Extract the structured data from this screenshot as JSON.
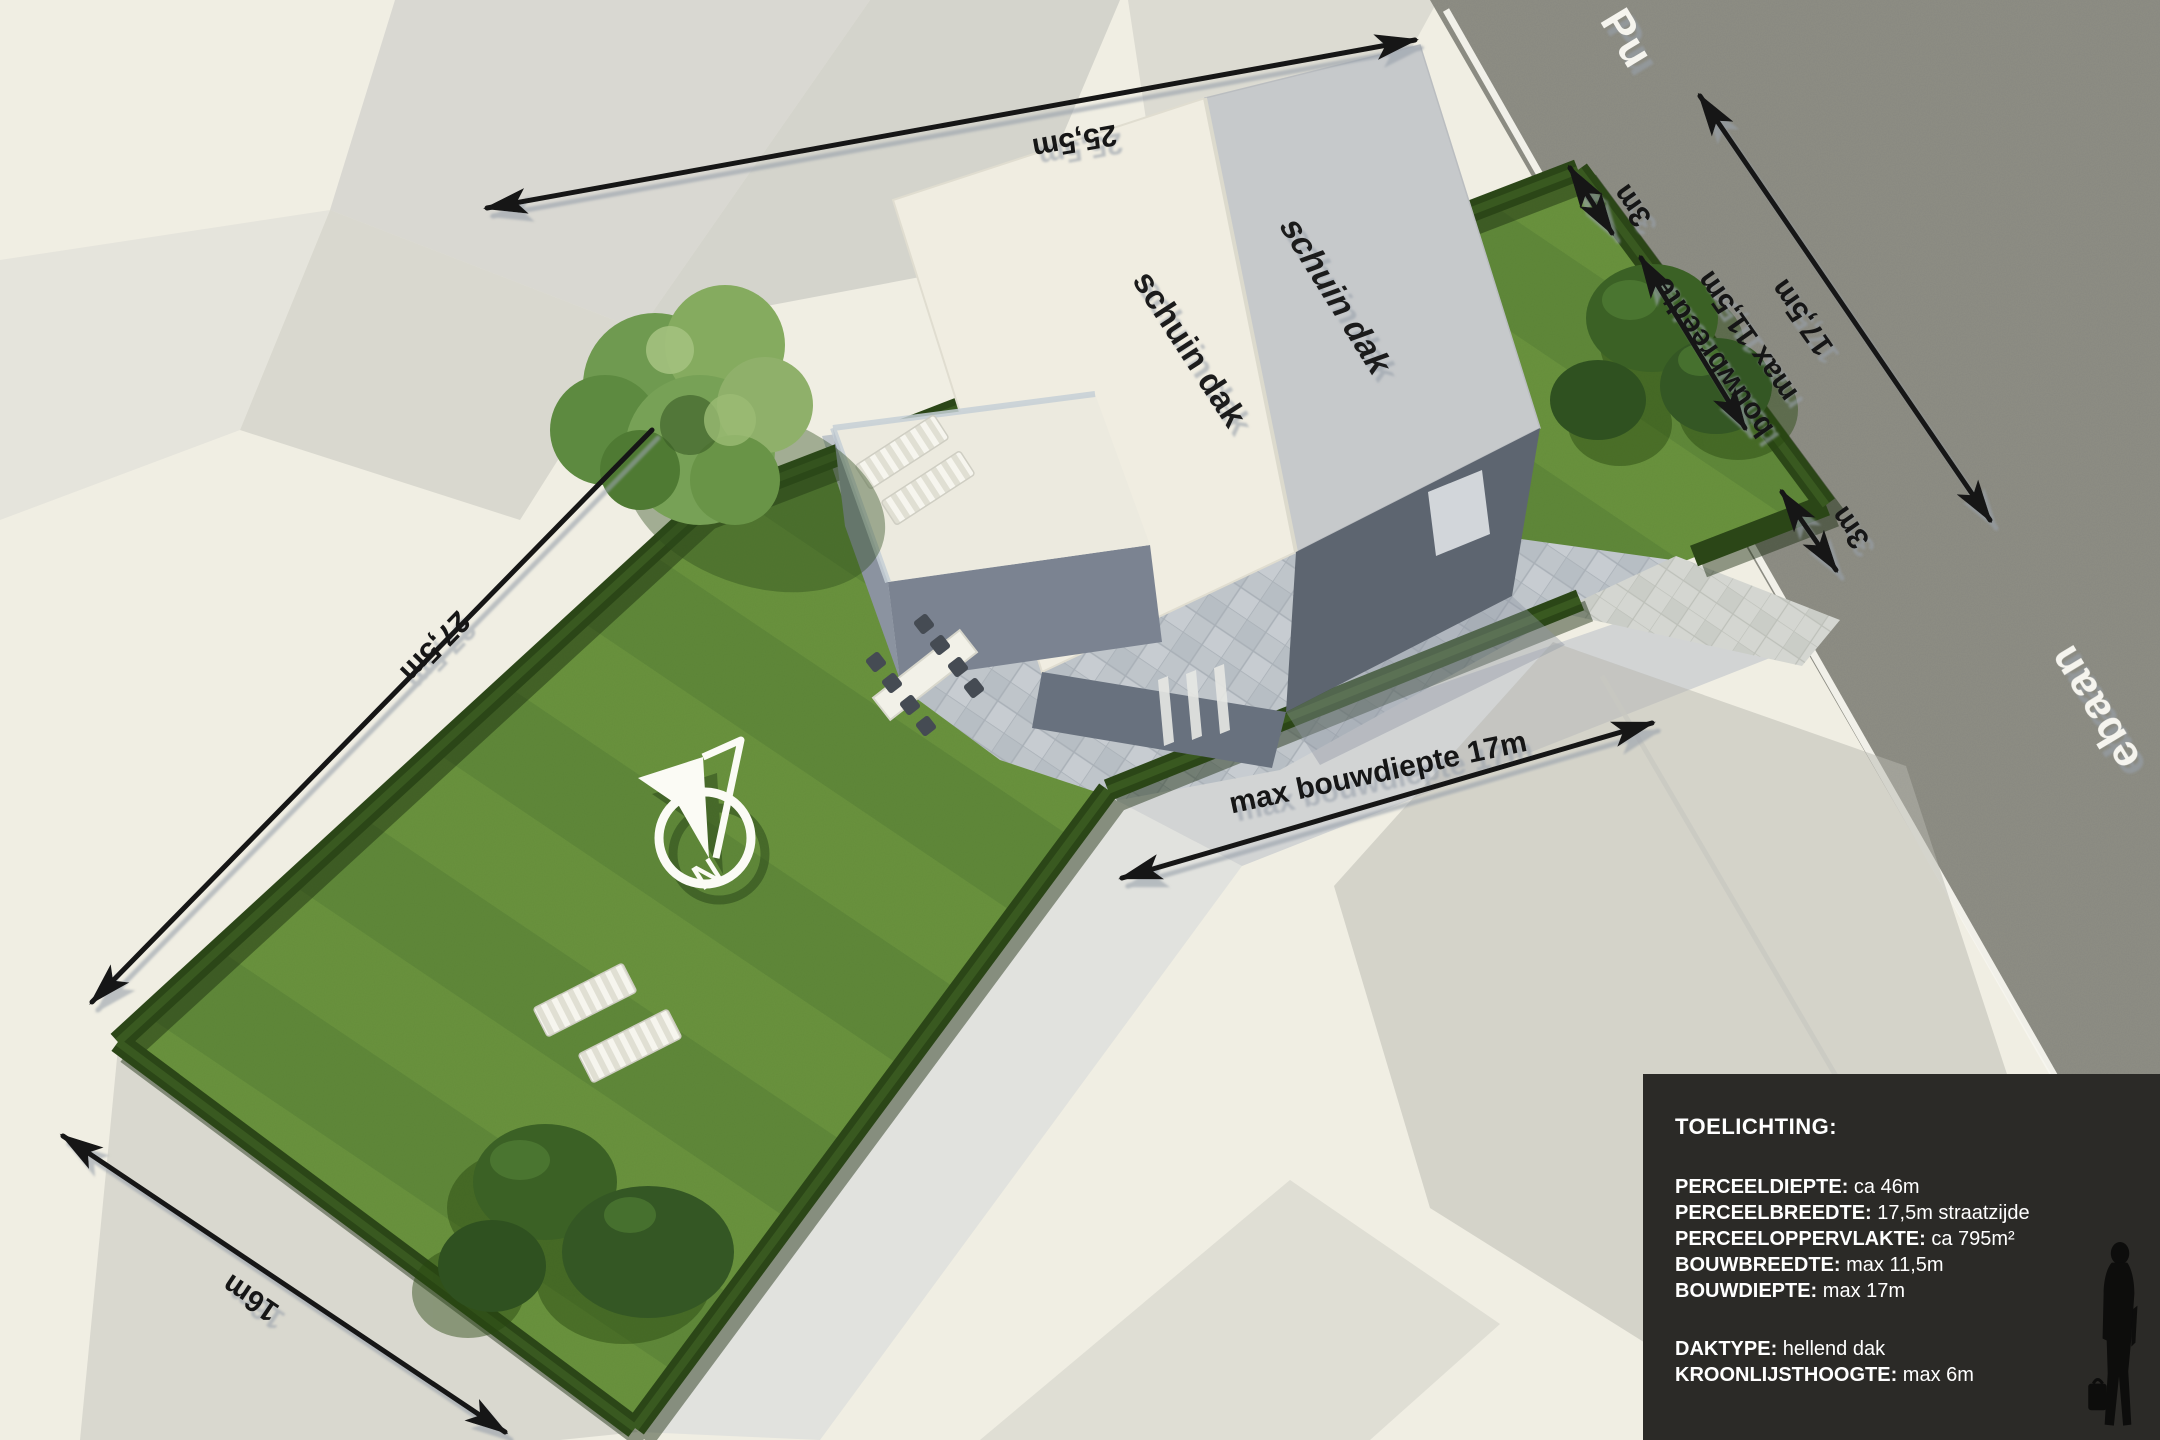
{
  "labels": {
    "dim_25_5m": "25,5m",
    "dim_27_5m": "27,5m",
    "dim_16m": "16m",
    "dim_3m_north": "3m",
    "dim_3m_south": "3m",
    "bouwbreedte_line1": "bouwbreedte",
    "bouwbreedte_line2": "max 11,5m",
    "dim_17_5m": "17,5m",
    "max_bouwdiepte": "max bouwdiepte 17m",
    "roof_label_left": "schuin dak",
    "roof_label_right": "schuin dak",
    "compass_north": "N",
    "street_name_fragment_top": "Pu",
    "street_name_fragment_right": "ebaan"
  },
  "legend": {
    "title": "TOELICHTING:",
    "rows": [
      {
        "key": "PERCEELDIEPTE:",
        "value": "ca 46m"
      },
      {
        "key": "PERCEELBREEDTE:",
        "value": "17,5m straatzijde"
      },
      {
        "key": "PERCEELOPPERVLAKTE:",
        "value": "ca 795m²"
      },
      {
        "key": "BOUWBREEDTE:",
        "value": "max 11,5m"
      },
      {
        "key": "BOUWDIEPTE:",
        "value": "max 17m"
      },
      {
        "key": "DAKTYPE:",
        "value": "hellend dak"
      },
      {
        "key": "KROONLIJSTHOOGTE:",
        "value": "max 6m"
      }
    ]
  },
  "colors": {
    "background": "#f0eee3",
    "grass": "#67903c",
    "hedge": "#2b4617",
    "road": "#8f8f86",
    "road_edge_line": "#f7f6ef",
    "roof_light": "#f0ede1",
    "roof_dark": "#c6c9cb",
    "wall_dark": "#5d6570",
    "dimension_text": "#161616",
    "legend_background": "#2b2a27",
    "legend_text": "#ffffff"
  }
}
